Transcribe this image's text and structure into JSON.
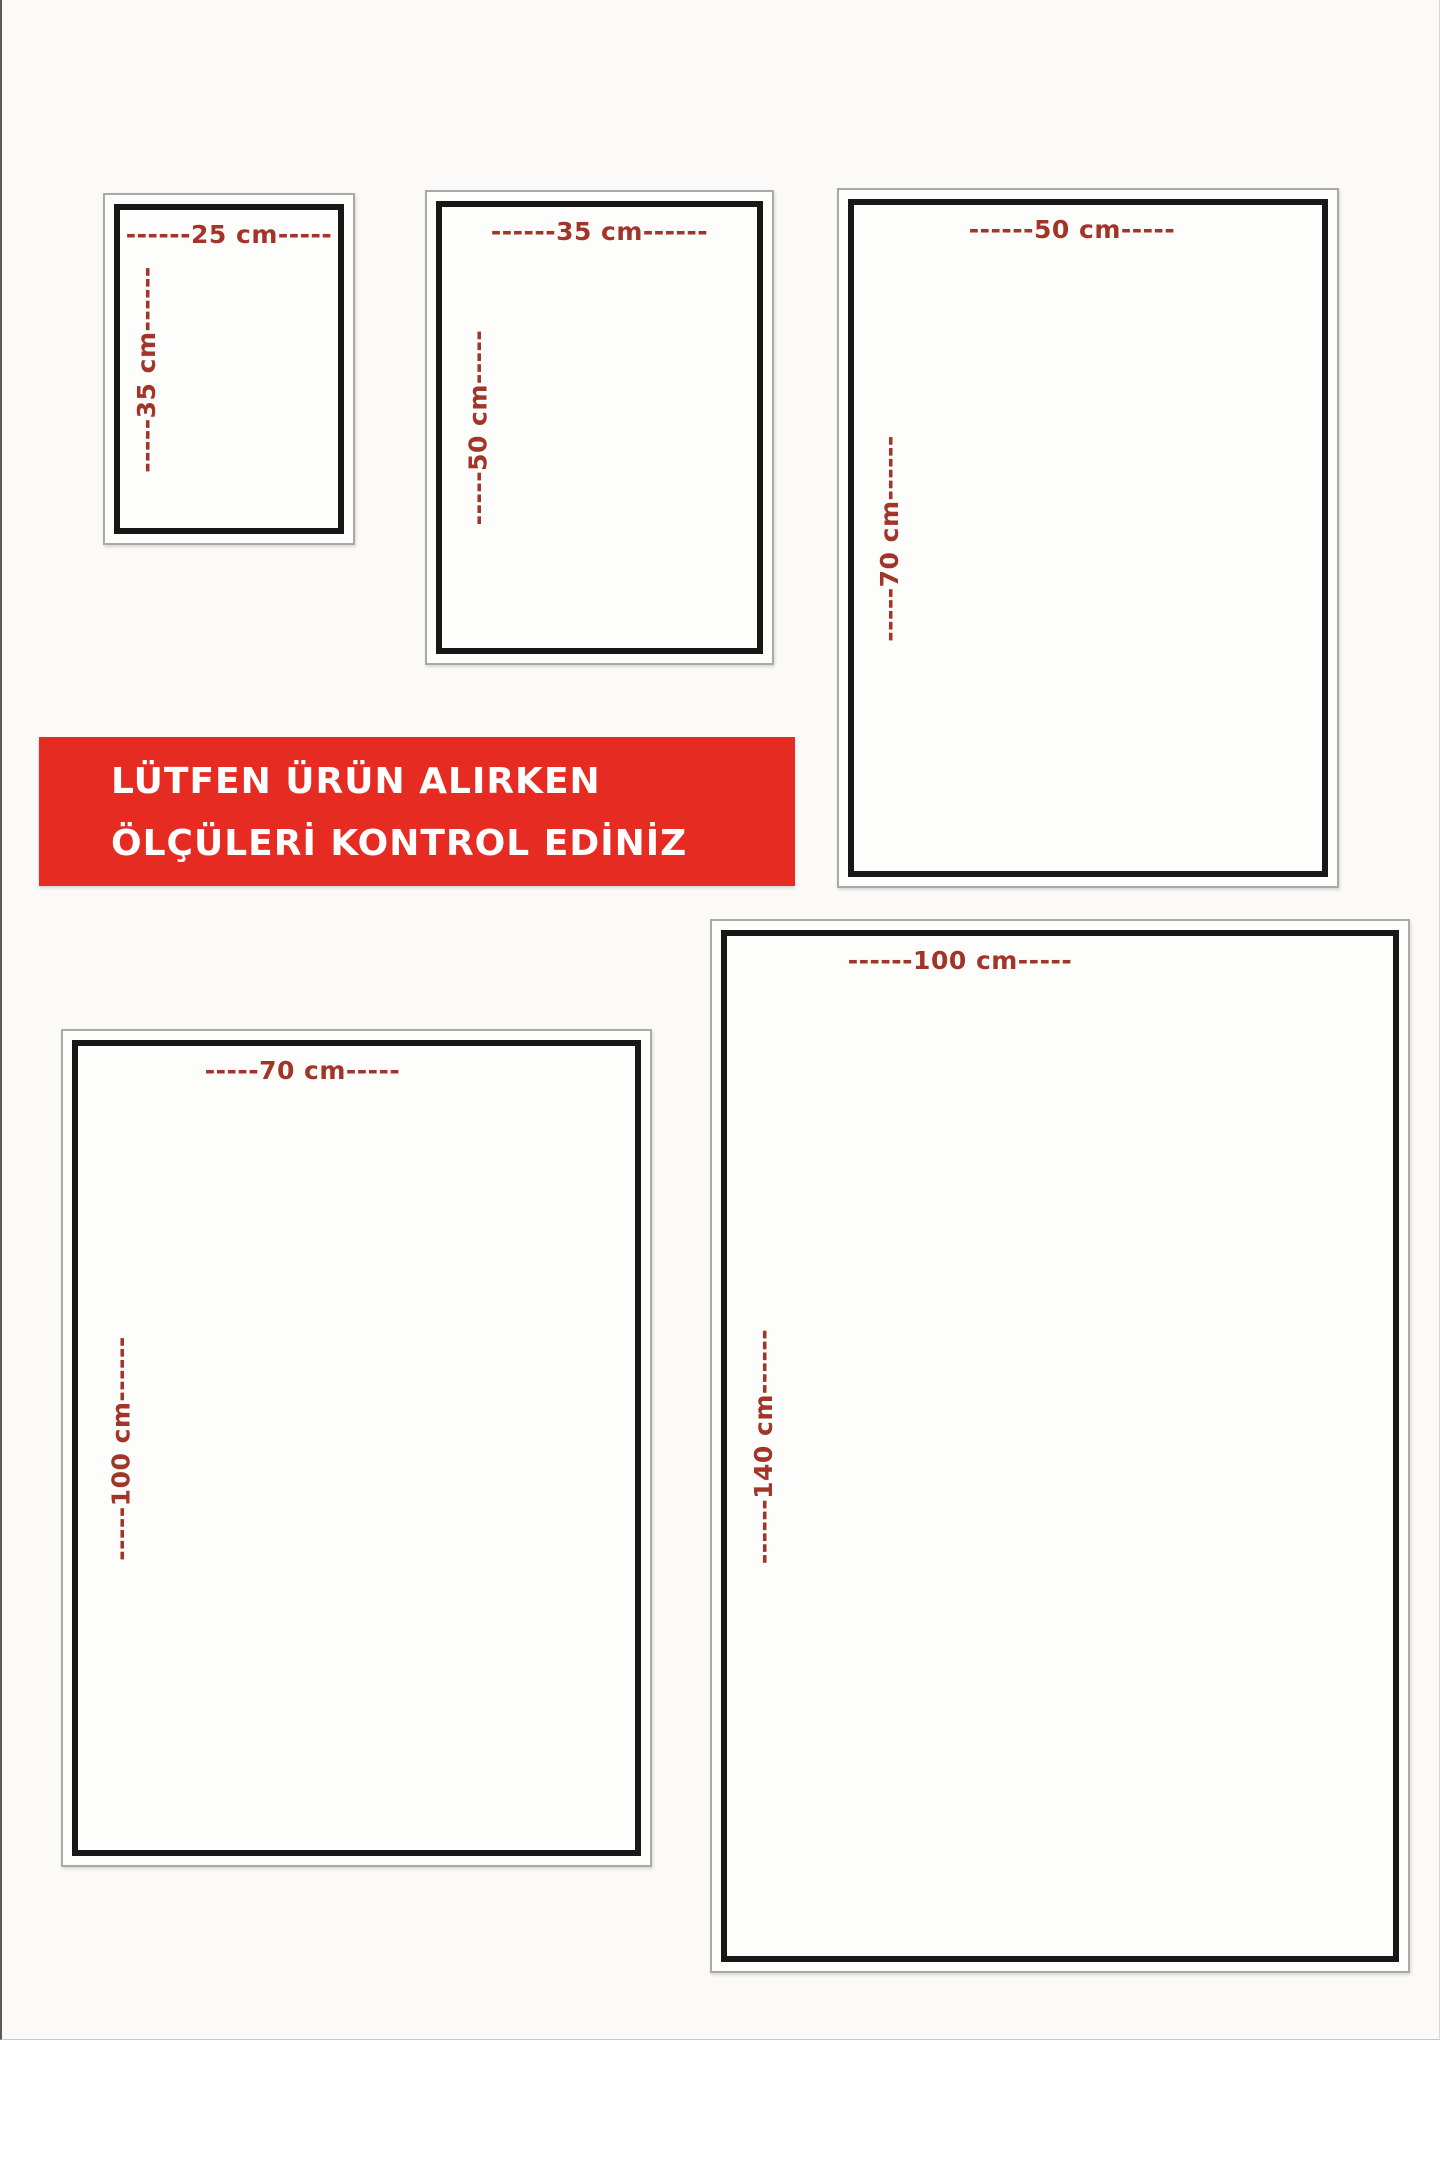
{
  "page": {
    "description": "product size guide diagram",
    "unit": "cm",
    "background_color": "#fbfaf8"
  },
  "banner": {
    "line1": "LÜTFEN ÜRÜN ALIRKEN",
    "line2": "ÖLÇÜLERİ KONTROL EDİNİZ",
    "background_color": "#e52b22",
    "text_color": "#ffffff"
  },
  "colors": {
    "dimension_text": "#a23428",
    "frame_border": "#181818",
    "frame_outline": "#a9a9a9"
  },
  "sizes": [
    {
      "name": "25x35",
      "width_cm": 25,
      "height_cm": 35,
      "width_label": "------25 cm-----",
      "height_label": "-----35 cm------"
    },
    {
      "name": "35x50",
      "width_cm": 35,
      "height_cm": 50,
      "width_label": "------35 cm------",
      "height_label": "-----50 cm-----"
    },
    {
      "name": "50x70",
      "width_cm": 50,
      "height_cm": 70,
      "width_label": "------50 cm-----",
      "height_label": "-----70 cm------"
    },
    {
      "name": "70x100",
      "width_cm": 70,
      "height_cm": 100,
      "width_label": "-----70 cm-----",
      "height_label": "-----100 cm------"
    },
    {
      "name": "100x140",
      "width_cm": 100,
      "height_cm": 140,
      "width_label": "------100 cm-----",
      "height_label": "------140 cm------"
    }
  ]
}
